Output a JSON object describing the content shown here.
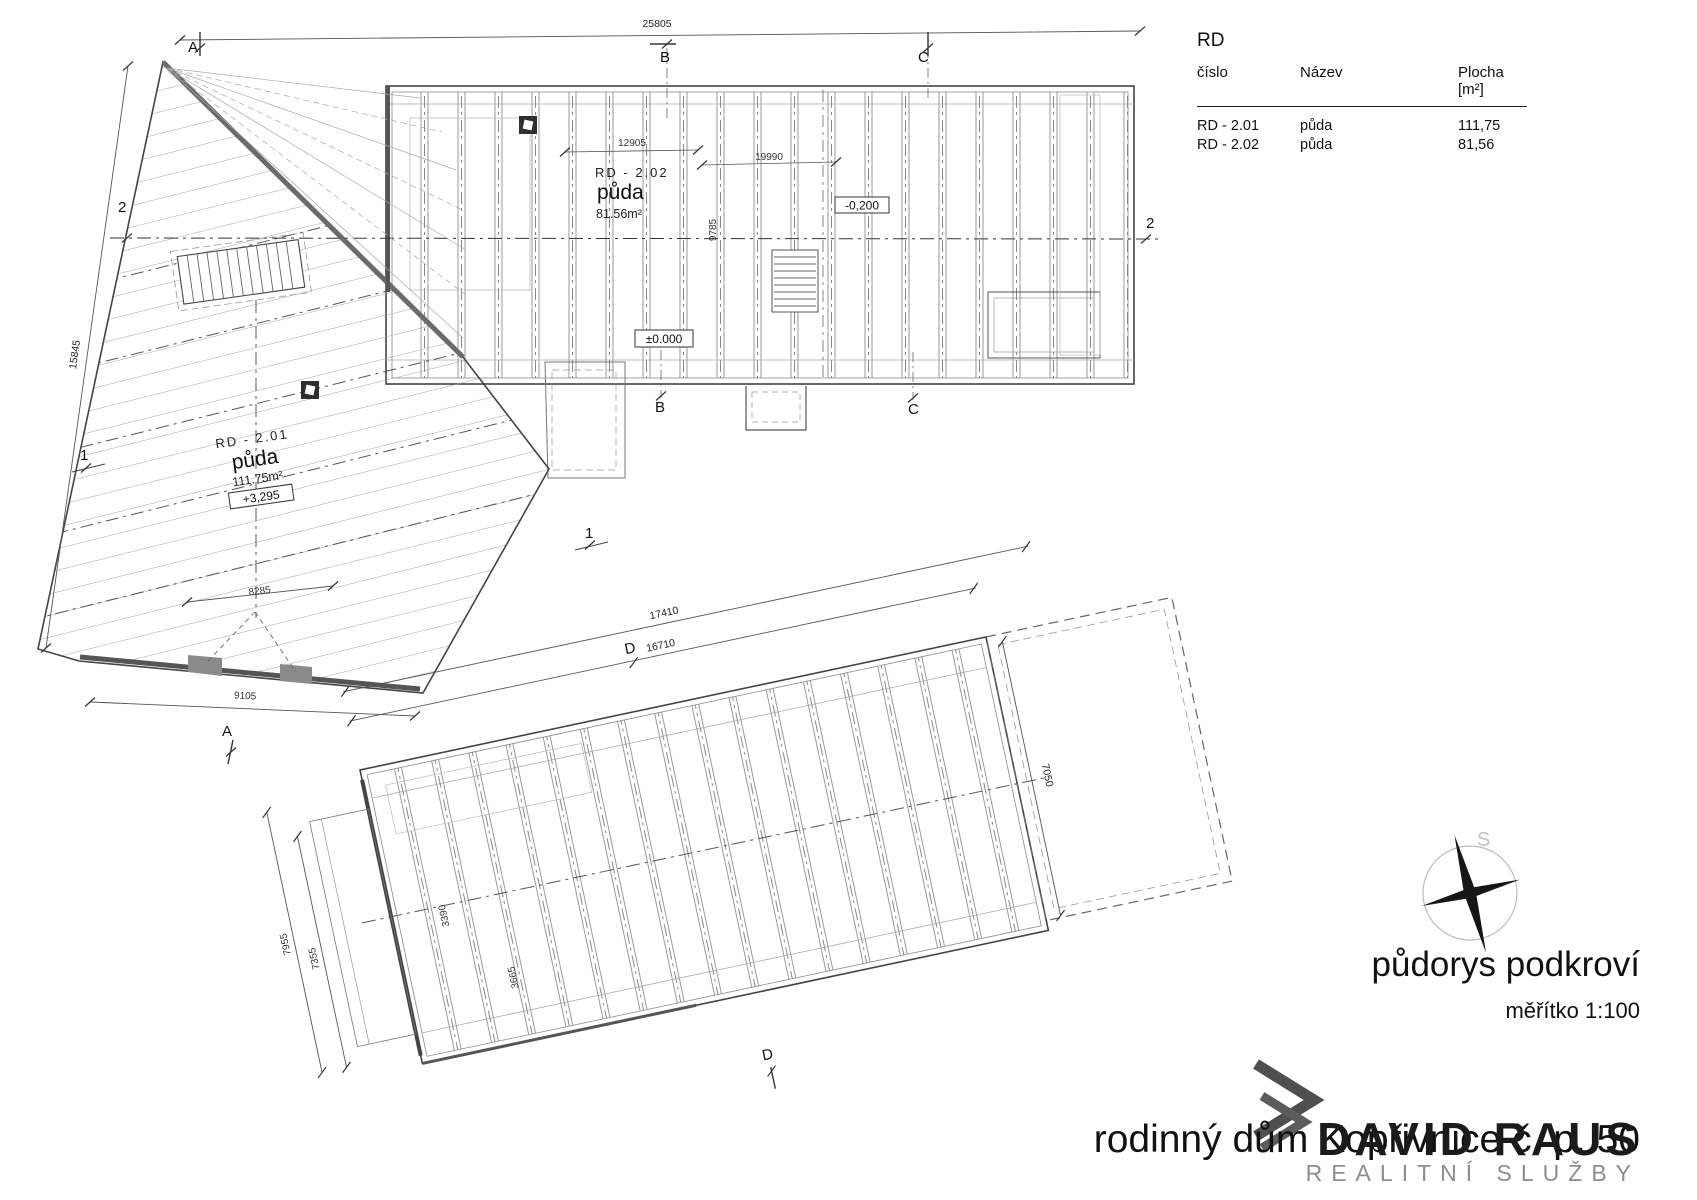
{
  "table": {
    "title": "RD",
    "col_cislo": "číslo",
    "col_nazev": "Název",
    "col_plocha": "Plocha [m²]",
    "rows": [
      {
        "cislo": "RD - 2.01",
        "nazev": "půda",
        "plocha": "111,75"
      },
      {
        "cislo": "RD - 2.02",
        "nazev": "půda",
        "plocha": "81,56"
      }
    ]
  },
  "titleblock": {
    "drawing_title": "půdorys podkroví",
    "scale": "měřítko 1:100",
    "project_title": "rodinný dům Kopřivnice č. p. 50"
  },
  "logo": {
    "name": "DAVID RAUS",
    "subtitle": "REALITNÍ SLUŽBY"
  },
  "compass": {
    "north_label": "S"
  },
  "plan_upper": {
    "room_201": {
      "id": "RD - 2.01",
      "name": "půda",
      "area": "111.75m²",
      "level": "+3,295"
    },
    "room_202": {
      "id": "RD - 2.02",
      "name": "půda",
      "area": "81.56m²"
    },
    "level_zero": "±0.000",
    "level_minus": "-0,200",
    "dim_total": "25805",
    "dim_12905": "12905",
    "dim_19990": "19990",
    "dim_9785": "9785",
    "dim_left": "15845",
    "dim_8285": "8285",
    "dim_9105": "9105"
  },
  "plan_lower": {
    "dim_17410": "17410",
    "dim_16710": "16710",
    "dim_7050": "7050",
    "dim_7955": "7955",
    "dim_7355": "7355",
    "dim_3390": "3390",
    "dim_3665": "3665"
  },
  "sections": {
    "a": "A",
    "b": "B",
    "c": "C",
    "d": "D",
    "s1": "1",
    "s2": "2"
  }
}
